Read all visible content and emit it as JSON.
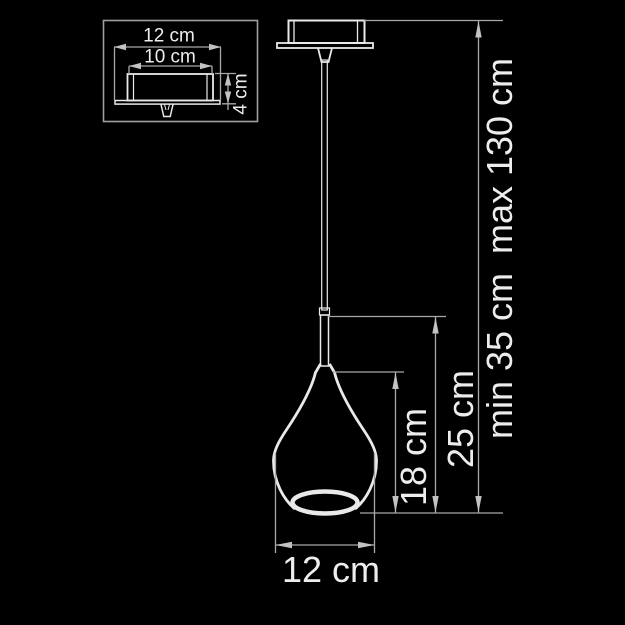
{
  "colors": {
    "background": "#000000",
    "dimension_line": "#a8a8a8",
    "arrowhead": "#c2c2c2",
    "drawing_outline": "#e9e9e9",
    "label_text": "#ededed"
  },
  "inset": {
    "canopy_outer_width": "12 cm",
    "canopy_inner_width": "10 cm",
    "canopy_height": "4 cm"
  },
  "main": {
    "shade_height": "18 cm",
    "shade_with_stem_height": "25 cm",
    "suspension_min": "min 35 cm",
    "suspension_max": "max 130 cm",
    "shade_diameter": "12 cm"
  }
}
